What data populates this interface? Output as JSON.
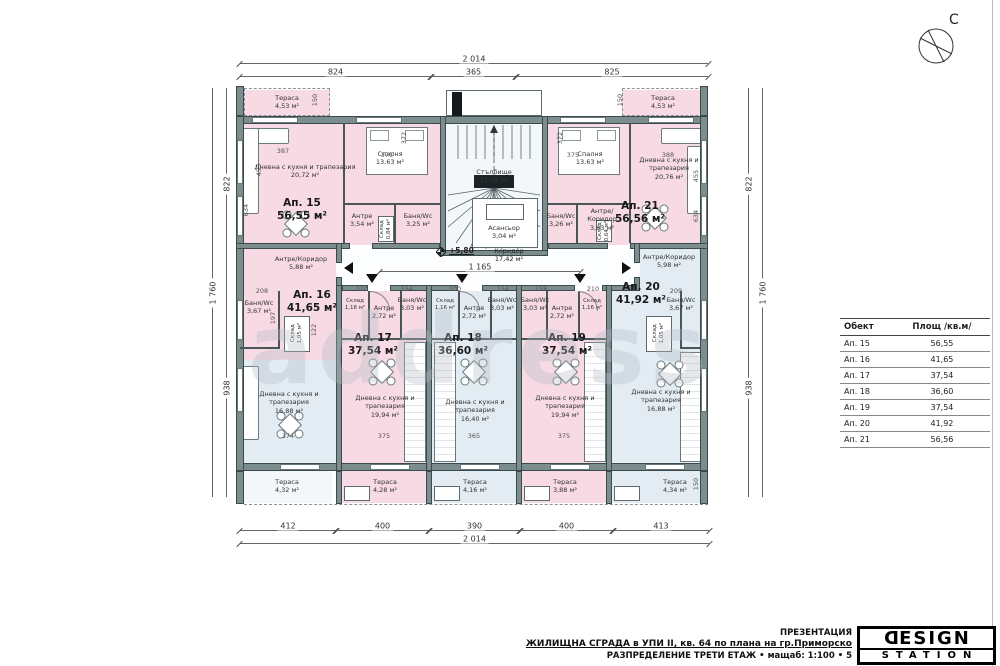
{
  "sheet": {
    "compass_label": "С",
    "watermark": "address"
  },
  "dims": {
    "top_total": "2 014",
    "top": [
      "824",
      "365",
      "825"
    ],
    "bottom": [
      "412",
      "400",
      "390",
      "400",
      "413"
    ],
    "bottom_total": "2 014",
    "left": [
      "822",
      "938"
    ],
    "left_total": "1 760",
    "right": [
      "822",
      "938"
    ],
    "right_total": "1 760",
    "inner": {
      "i387": "387",
      "i375a": "375",
      "i372a": "372",
      "i375b": "375",
      "i372b": "372",
      "i388": "388",
      "i455l": "455",
      "i634l": "634",
      "i455r": "455",
      "i634r": "634",
      "i150tl": "150",
      "i150tr": "150",
      "i150br": "150",
      "i210a": "210",
      "i154a": "154",
      "i200": "200",
      "i154b": "154",
      "i158": "158",
      "i210b": "210",
      "i208": "208",
      "i197": "197",
      "i122": "122",
      "i209": "209",
      "i374": "374",
      "i375c": "375",
      "i365": "365",
      "i375d": "375",
      "i1165": "1 165"
    }
  },
  "core": {
    "stairs_name": "Стълбище",
    "stairs_area": "12,58 м²",
    "elevator_name": "Асансьор",
    "elevator_area": "3,04 м²",
    "corridor_name": "Коридор",
    "corridor_area": "17,42 м²",
    "level": "+5,80"
  },
  "apartments": [
    {
      "id": "Ап. 15",
      "total": "56,55 м²",
      "rooms": [
        {
          "n": "Тераса",
          "a": "4,53 м²"
        },
        {
          "n": "Дневна с кухня и трапезария",
          "a": "20,72 м²"
        },
        {
          "n": "Спалня",
          "a": "13,63 м²"
        },
        {
          "n": "Антре",
          "a": "3,54 м²"
        },
        {
          "n": "Баня/Wc",
          "a": "3,25 м²"
        },
        {
          "n": "Склад",
          "a": "0,84 м²"
        }
      ]
    },
    {
      "id": "Ап. 16",
      "total": "41,65 м²",
      "rooms": [
        {
          "n": "Антре/Коридор",
          "a": "5,88 м²"
        },
        {
          "n": "Баня/Wc",
          "a": "3,67 м²"
        },
        {
          "n": "Склад",
          "a": "1,05 м²"
        },
        {
          "n": "Дневна с кухня и трапезария",
          "a": "16,88 м²"
        },
        {
          "n": "Тераса",
          "a": "4,32 м²"
        }
      ]
    },
    {
      "id": "Ап. 17",
      "total": "37,54 м²",
      "rooms": [
        {
          "n": "Склад",
          "a": "1,16 м²"
        },
        {
          "n": "Антре",
          "a": "2,72 м²"
        },
        {
          "n": "Баня/Wc",
          "a": "3,03 м²"
        },
        {
          "n": "Дневна с кухня и трапезария",
          "a": "19,94 м²"
        },
        {
          "n": "Тераса",
          "a": "4,28 м²"
        }
      ]
    },
    {
      "id": "Ап. 18",
      "total": "36,60 м²",
      "rooms": [
        {
          "n": "Склад",
          "a": "1,16 м²"
        },
        {
          "n": "Антре",
          "a": "2,72 м²"
        },
        {
          "n": "Баня/Wc",
          "a": "3,03 м²"
        },
        {
          "n": "Дневна с кухня и трапезария",
          "a": "16,40 м²"
        },
        {
          "n": "Тераса",
          "a": "4,16 м²"
        }
      ]
    },
    {
      "id": "Ап. 19",
      "total": "37,54 м²",
      "rooms": [
        {
          "n": "Баня/Wc",
          "a": "3,03 м²"
        },
        {
          "n": "Антре",
          "a": "2,72 м²"
        },
        {
          "n": "Склад",
          "a": "1,16 м²"
        },
        {
          "n": "Дневна с кухня и трапезария",
          "a": "19,94 м²"
        },
        {
          "n": "Тераса",
          "a": "3,88 м²"
        }
      ]
    },
    {
      "id": "Ап. 20",
      "total": "41,92 м²",
      "rooms": [
        {
          "n": "Антре/Коридор",
          "a": "5,98 м²"
        },
        {
          "n": "Склад",
          "a": "1,05 м²"
        },
        {
          "n": "Баня/Wc",
          "a": "3,67 м²"
        },
        {
          "n": "Дневна с кухня и трапезария",
          "a": "16,88 м²"
        },
        {
          "n": "Тераса",
          "a": "4,34 м²"
        }
      ]
    },
    {
      "id": "Ап. 21",
      "total": "56,56 м²",
      "rooms": [
        {
          "n": "Тераса",
          "a": "4,53 м²"
        },
        {
          "n": "Спалня",
          "a": "13,63 м²"
        },
        {
          "n": "Антре/Коридор",
          "a": "3,83 м²"
        },
        {
          "n": "Баня/Wc",
          "a": "3,26 м²"
        },
        {
          "n": "Склад",
          "a": "0,64 м²"
        },
        {
          "n": "Дневна с кухня и трапезария",
          "a": "20,76 м²"
        }
      ]
    }
  ],
  "legend_table": {
    "headers": [
      "Обект",
      "Площ /кв.м/"
    ],
    "rows": [
      [
        "Ап. 15",
        "56,55"
      ],
      [
        "Ап. 16",
        "41,65"
      ],
      [
        "Ап. 17",
        "37,54"
      ],
      [
        "Ап. 18",
        "36,60"
      ],
      [
        "Ап. 19",
        "37,54"
      ],
      [
        "Ап. 20",
        "41,92"
      ],
      [
        "Ап. 21",
        "56,56"
      ]
    ]
  },
  "titleblock": {
    "l1": "ПРЕЗЕНТАЦИЯ",
    "l2": "ЖИЛИЩНА СГРАДА в УПИ II, кв. 64 по плана на гр.Приморско",
    "l3": "РАЗПРЕДЕЛЕНИЕ ТРЕТИ ЕТАЖ • мащаб: 1:100 • 5"
  },
  "logo": {
    "top_d": "D",
    "top_rest": "ESIGN",
    "bottom": "STATION"
  }
}
